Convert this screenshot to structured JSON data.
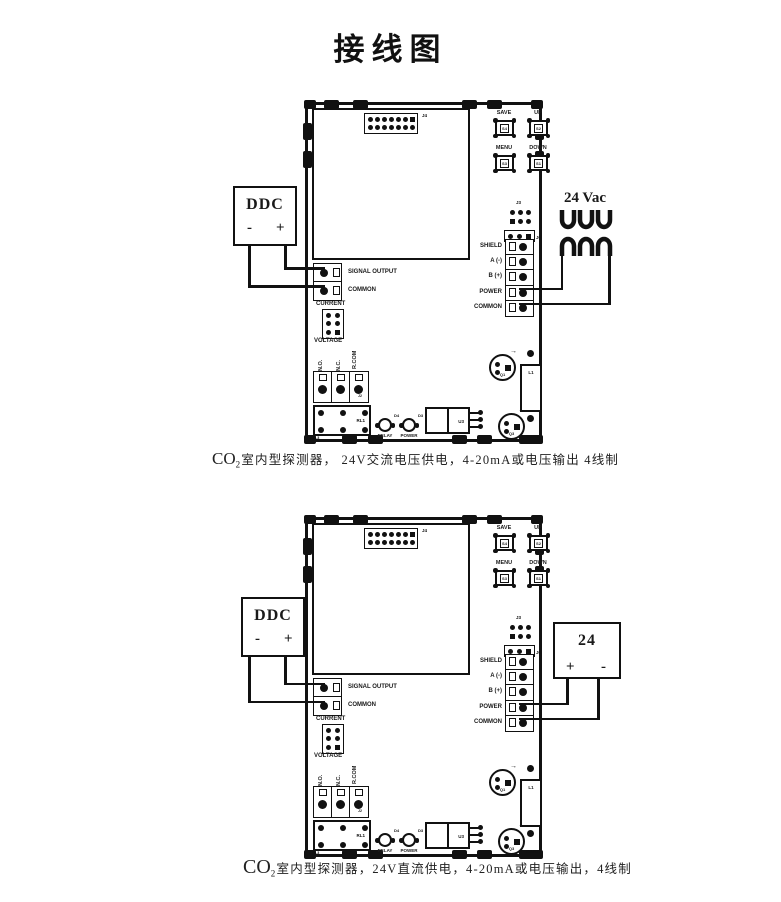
{
  "title": "接线图",
  "board": {
    "connector_j4": "J4",
    "buttons": {
      "save": {
        "label": "SAVE",
        "ref": "S4"
      },
      "up": {
        "label": "UP",
        "ref": "S2"
      },
      "menu": {
        "label": "MENU",
        "ref": "S3"
      },
      "down": {
        "label": "DOWN",
        "ref": "S1"
      }
    },
    "header_j3": "J3",
    "j6": "J6",
    "comm_terminals": [
      "SHIELD",
      "A (-)",
      "B (+)",
      "POWER",
      "COMMON"
    ],
    "output_terminals": [
      "SIGNAL OUTPUT",
      "COMMON"
    ],
    "jumper_top": "CURRENT",
    "jumper_bottom": "VOLTAGE",
    "relay_terminals": [
      "N.O.",
      "N.C.",
      "R.COM"
    ],
    "j2": "J2",
    "relay_ref": "RL1",
    "corner_ref": "SL3",
    "leds": [
      {
        "label": "RELAY",
        "ref": "D4"
      },
      {
        "label": "POWER",
        "ref": "D3"
      }
    ],
    "u3": "U3",
    "q1": "Q1",
    "q3": "Q3",
    "l1": "L1",
    "switch_ref": "SWITCH"
  },
  "diagram1": {
    "ddc": {
      "title": "DDC",
      "minus": "-",
      "plus": "+"
    },
    "power_label": "24 Vac",
    "caption": {
      "co": "CO",
      "sub": "2",
      "text": "室内型探测器， 24V交流电压供电，4-20mA或电压输出 4线制"
    }
  },
  "diagram2": {
    "ddc": {
      "title": "DDC",
      "minus": "-",
      "plus": "+"
    },
    "power": {
      "label": "24",
      "plus": "+",
      "minus": "-"
    },
    "caption": {
      "co": "CO",
      "sub": "2",
      "text": "室内型探测器，24V直流供电，4-20mA或电压输出，4线制"
    }
  },
  "colors": {
    "ink": "#1a1a1a",
    "bg": "#ffffff"
  }
}
